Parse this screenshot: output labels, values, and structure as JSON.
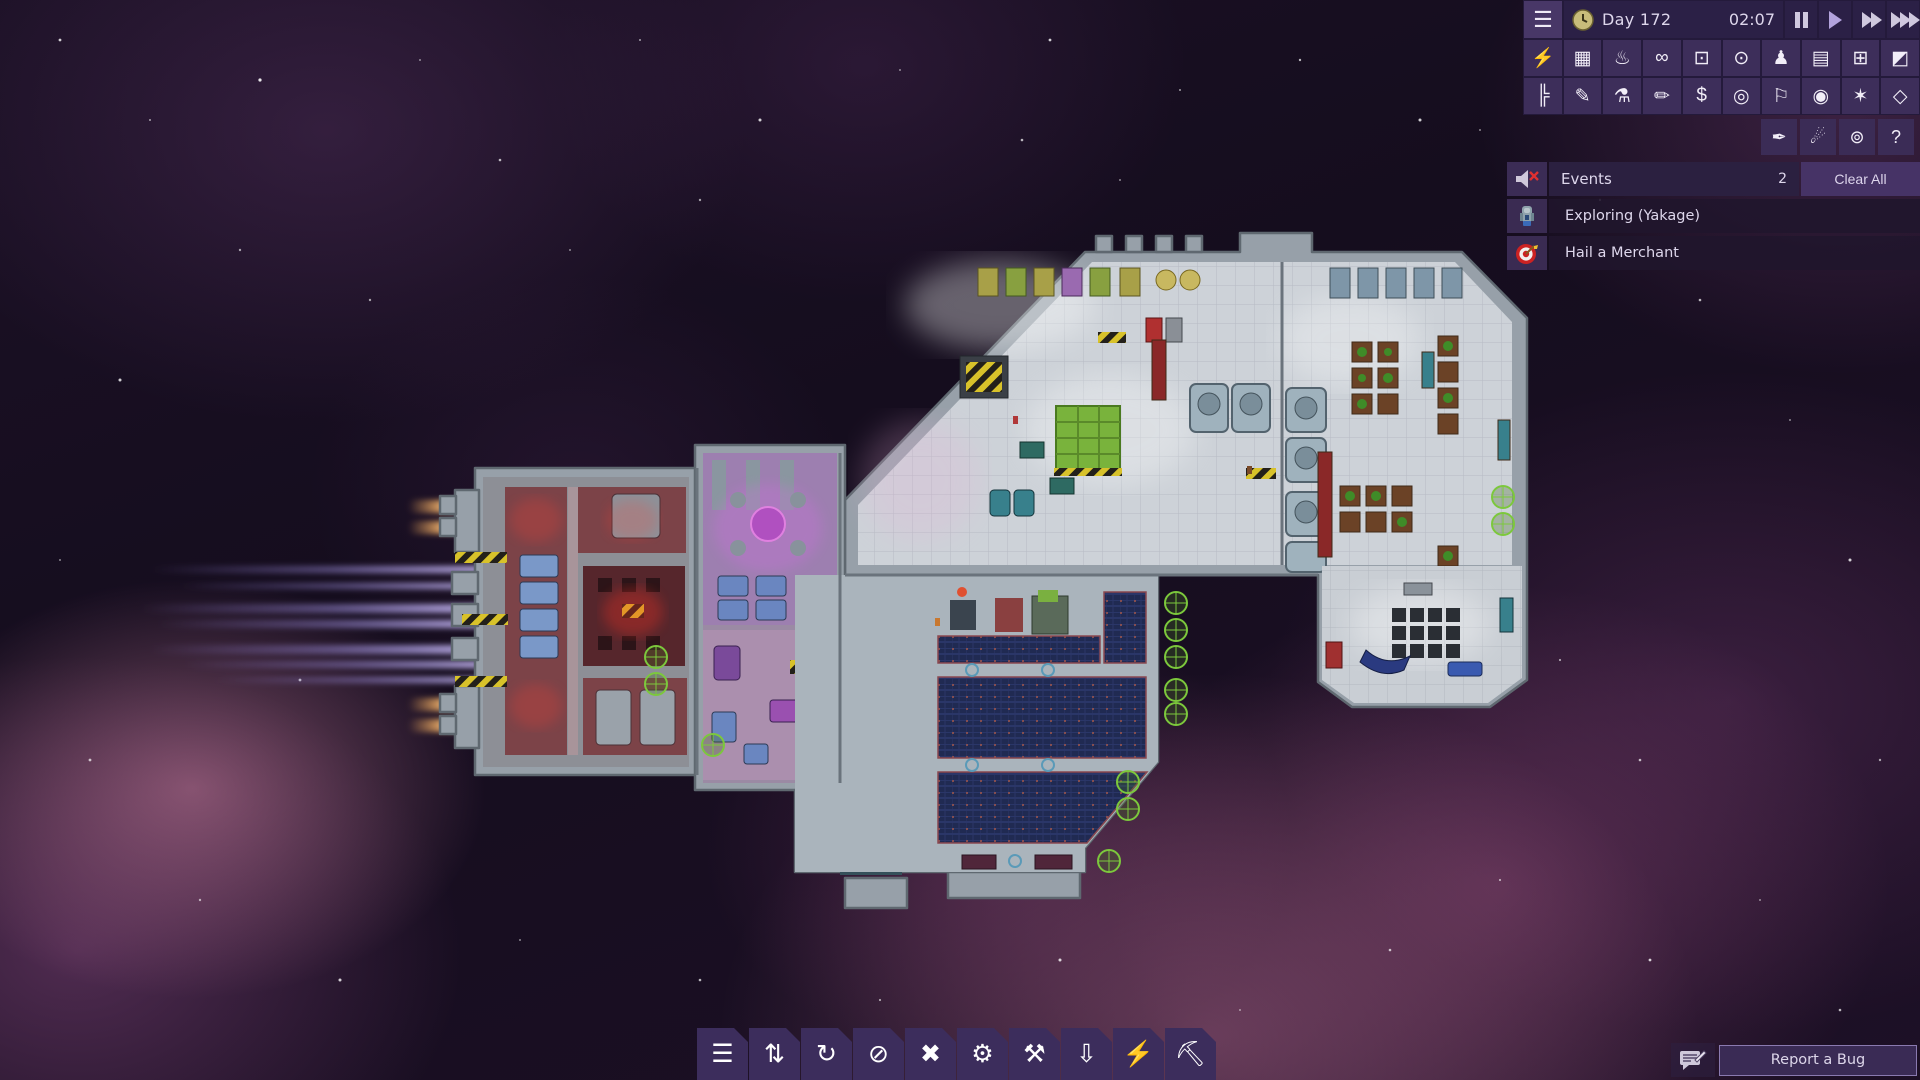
{
  "hud": {
    "menu": {
      "name": "menu",
      "glyph": "☰"
    },
    "day_label": "Day 172",
    "time_label": "02:07",
    "speed_controls": [
      {
        "name": "pause"
      },
      {
        "name": "play",
        "active": true
      },
      {
        "name": "fast-forward"
      },
      {
        "name": "fastest"
      }
    ],
    "toolbar_row1": [
      {
        "name": "power",
        "glyph": "⚡"
      },
      {
        "name": "hull-tiles",
        "glyph": "▦"
      },
      {
        "name": "temperature",
        "glyph": "♨"
      },
      {
        "name": "gas",
        "glyph": "∞"
      },
      {
        "name": "temperature-overlay",
        "glyph": "⊡"
      },
      {
        "name": "gas-overlay",
        "glyph": "⊙"
      },
      {
        "name": "crew",
        "glyph": "♟"
      },
      {
        "name": "schedule",
        "glyph": "▤"
      },
      {
        "name": "facilities",
        "glyph": "⊞"
      },
      {
        "name": "zones",
        "glyph": "◩"
      }
    ],
    "toolbar_row2": [
      {
        "name": "logistics",
        "glyph": "╠"
      },
      {
        "name": "draw",
        "glyph": "✎"
      },
      {
        "name": "research",
        "glyph": "⚗"
      },
      {
        "name": "log",
        "glyph": "✏"
      },
      {
        "name": "trade",
        "glyph": "$"
      },
      {
        "name": "missions",
        "glyph": "◎"
      },
      {
        "name": "navigation",
        "glyph": "⚐"
      },
      {
        "name": "view",
        "glyph": "◉"
      },
      {
        "name": "combat",
        "glyph": "✶"
      },
      {
        "name": "shield",
        "glyph": "◇"
      }
    ],
    "toolbar_row3": [
      {
        "name": "paint",
        "glyph": "✒"
      },
      {
        "name": "scanner",
        "glyph": "☄"
      },
      {
        "name": "system-view",
        "glyph": "⊚"
      },
      {
        "name": "help",
        "glyph": "?"
      }
    ]
  },
  "events_panel": {
    "mute_icon": "muted-speaker",
    "title": "Events",
    "count": "2",
    "clear_all_label": "Clear All",
    "events": [
      {
        "icon": "scout-ship",
        "label": "Exploring (Yakage)"
      },
      {
        "icon": "merchant-target",
        "label": "Hail a Merchant"
      }
    ]
  },
  "bottom_toolbar": [
    {
      "name": "manage",
      "glyph": "☰"
    },
    {
      "name": "priorities",
      "glyph": "⇅"
    },
    {
      "name": "rotate",
      "glyph": "↻"
    },
    {
      "name": "forbid",
      "glyph": "⊘"
    },
    {
      "name": "cancel",
      "glyph": "✖"
    },
    {
      "name": "settings",
      "glyph": "⚙"
    },
    {
      "name": "repair",
      "glyph": "⚒"
    },
    {
      "name": "salvage",
      "glyph": "⇩"
    },
    {
      "name": "power-tool",
      "glyph": "⚡"
    },
    {
      "name": "build",
      "glyph": "⛏"
    }
  ],
  "bug_report": {
    "label": "Report a Bug",
    "icon": "bug-report-chat"
  },
  "palette": {
    "panel": "#3d2e5a",
    "panel_dark": "#2b2046",
    "panel_gap": "#241a3b",
    "text": "#ded7ec",
    "accent_play": "#b3a3dd",
    "event_row_bg": "#201632",
    "clear_button_bg": "#463366",
    "hull_gray": "#97a0a9",
    "room_light": "#cdd2d8",
    "room_red": "#7c4348",
    "room_purple": "#9d7fb0",
    "solar_blue": "#202a52",
    "engine_trail": "#9b8ade",
    "thruster_flame": "#f0a858",
    "node_green": "#7cc83c"
  }
}
